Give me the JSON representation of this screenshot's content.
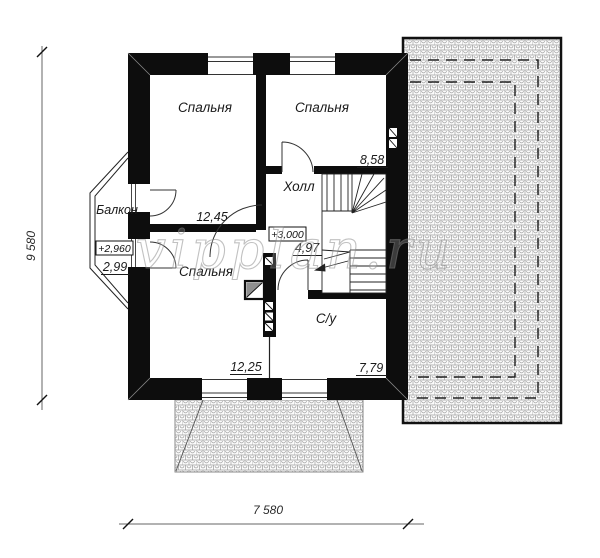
{
  "watermark": "vipplan.ru",
  "rooms": [
    {
      "id": "bedroom-1",
      "name": "Спальня",
      "area": "12,45"
    },
    {
      "id": "bedroom-2",
      "name": "Спальня",
      "area": "8,58"
    },
    {
      "id": "hall",
      "name": "Холл",
      "area": "4,97"
    },
    {
      "id": "bedroom-3",
      "name": "Спальня",
      "area": "12,25"
    },
    {
      "id": "bathroom",
      "name": "С/у",
      "area": "7,79"
    },
    {
      "id": "balcony",
      "name": "Балкон",
      "area": "2,99"
    }
  ],
  "elevation_marks": {
    "hall": "+3,000",
    "balcony": "+2,960"
  },
  "dimensions": {
    "overall_width": "7 580",
    "overall_height": "9 580"
  },
  "colors": {
    "wall": "#0d0d0d",
    "line": "#333333",
    "hatch_line": "#9c9c9c",
    "watermark": "#8f8f8f"
  }
}
